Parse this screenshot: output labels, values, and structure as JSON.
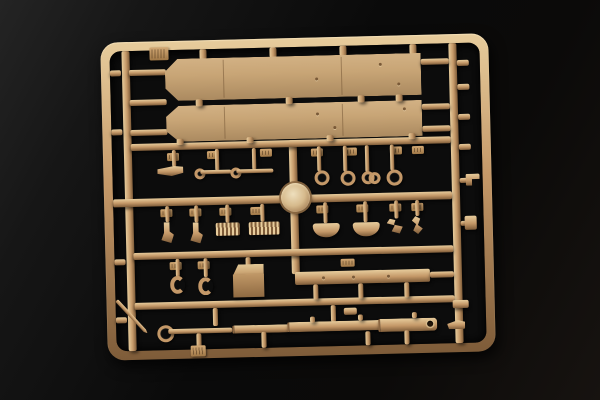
{
  "scene": {
    "type": "product-photo",
    "subject": "Tan injection-molded model kit sprue (parts frame) photographed on a black backdrop",
    "sprue": {
      "tilt_deg": -1.4,
      "contents": [
        "sprue letter tab on top rail",
        "two long fender/track-guard panels with rivet holes",
        "row of small brackets, linkage rods and eyelet rings",
        "round hatch/wheel disc at the crossing of the center runners",
        "hooks, clamps and two ribbed grille blocks",
        "two curved bracket parts and small twisted fittings",
        "C-shaped hooks and a stowage box",
        "long flat mounting bar with three holes",
        "multi-section gun barrel with open muzzle",
        "thin tapered antenna rod",
        "small embossed part-number tabs along the runners"
      ]
    },
    "colors": {
      "background_top": "#242424",
      "background_mid": "#0a0a0a",
      "background_low": "#171310",
      "plastic_highlight": "#e7cc9c",
      "plastic_mid": "#c49868",
      "plastic_shadow": "#7e5c39",
      "panel_face": "#c8a576",
      "cutout_dark": "#0c0c0c"
    }
  }
}
